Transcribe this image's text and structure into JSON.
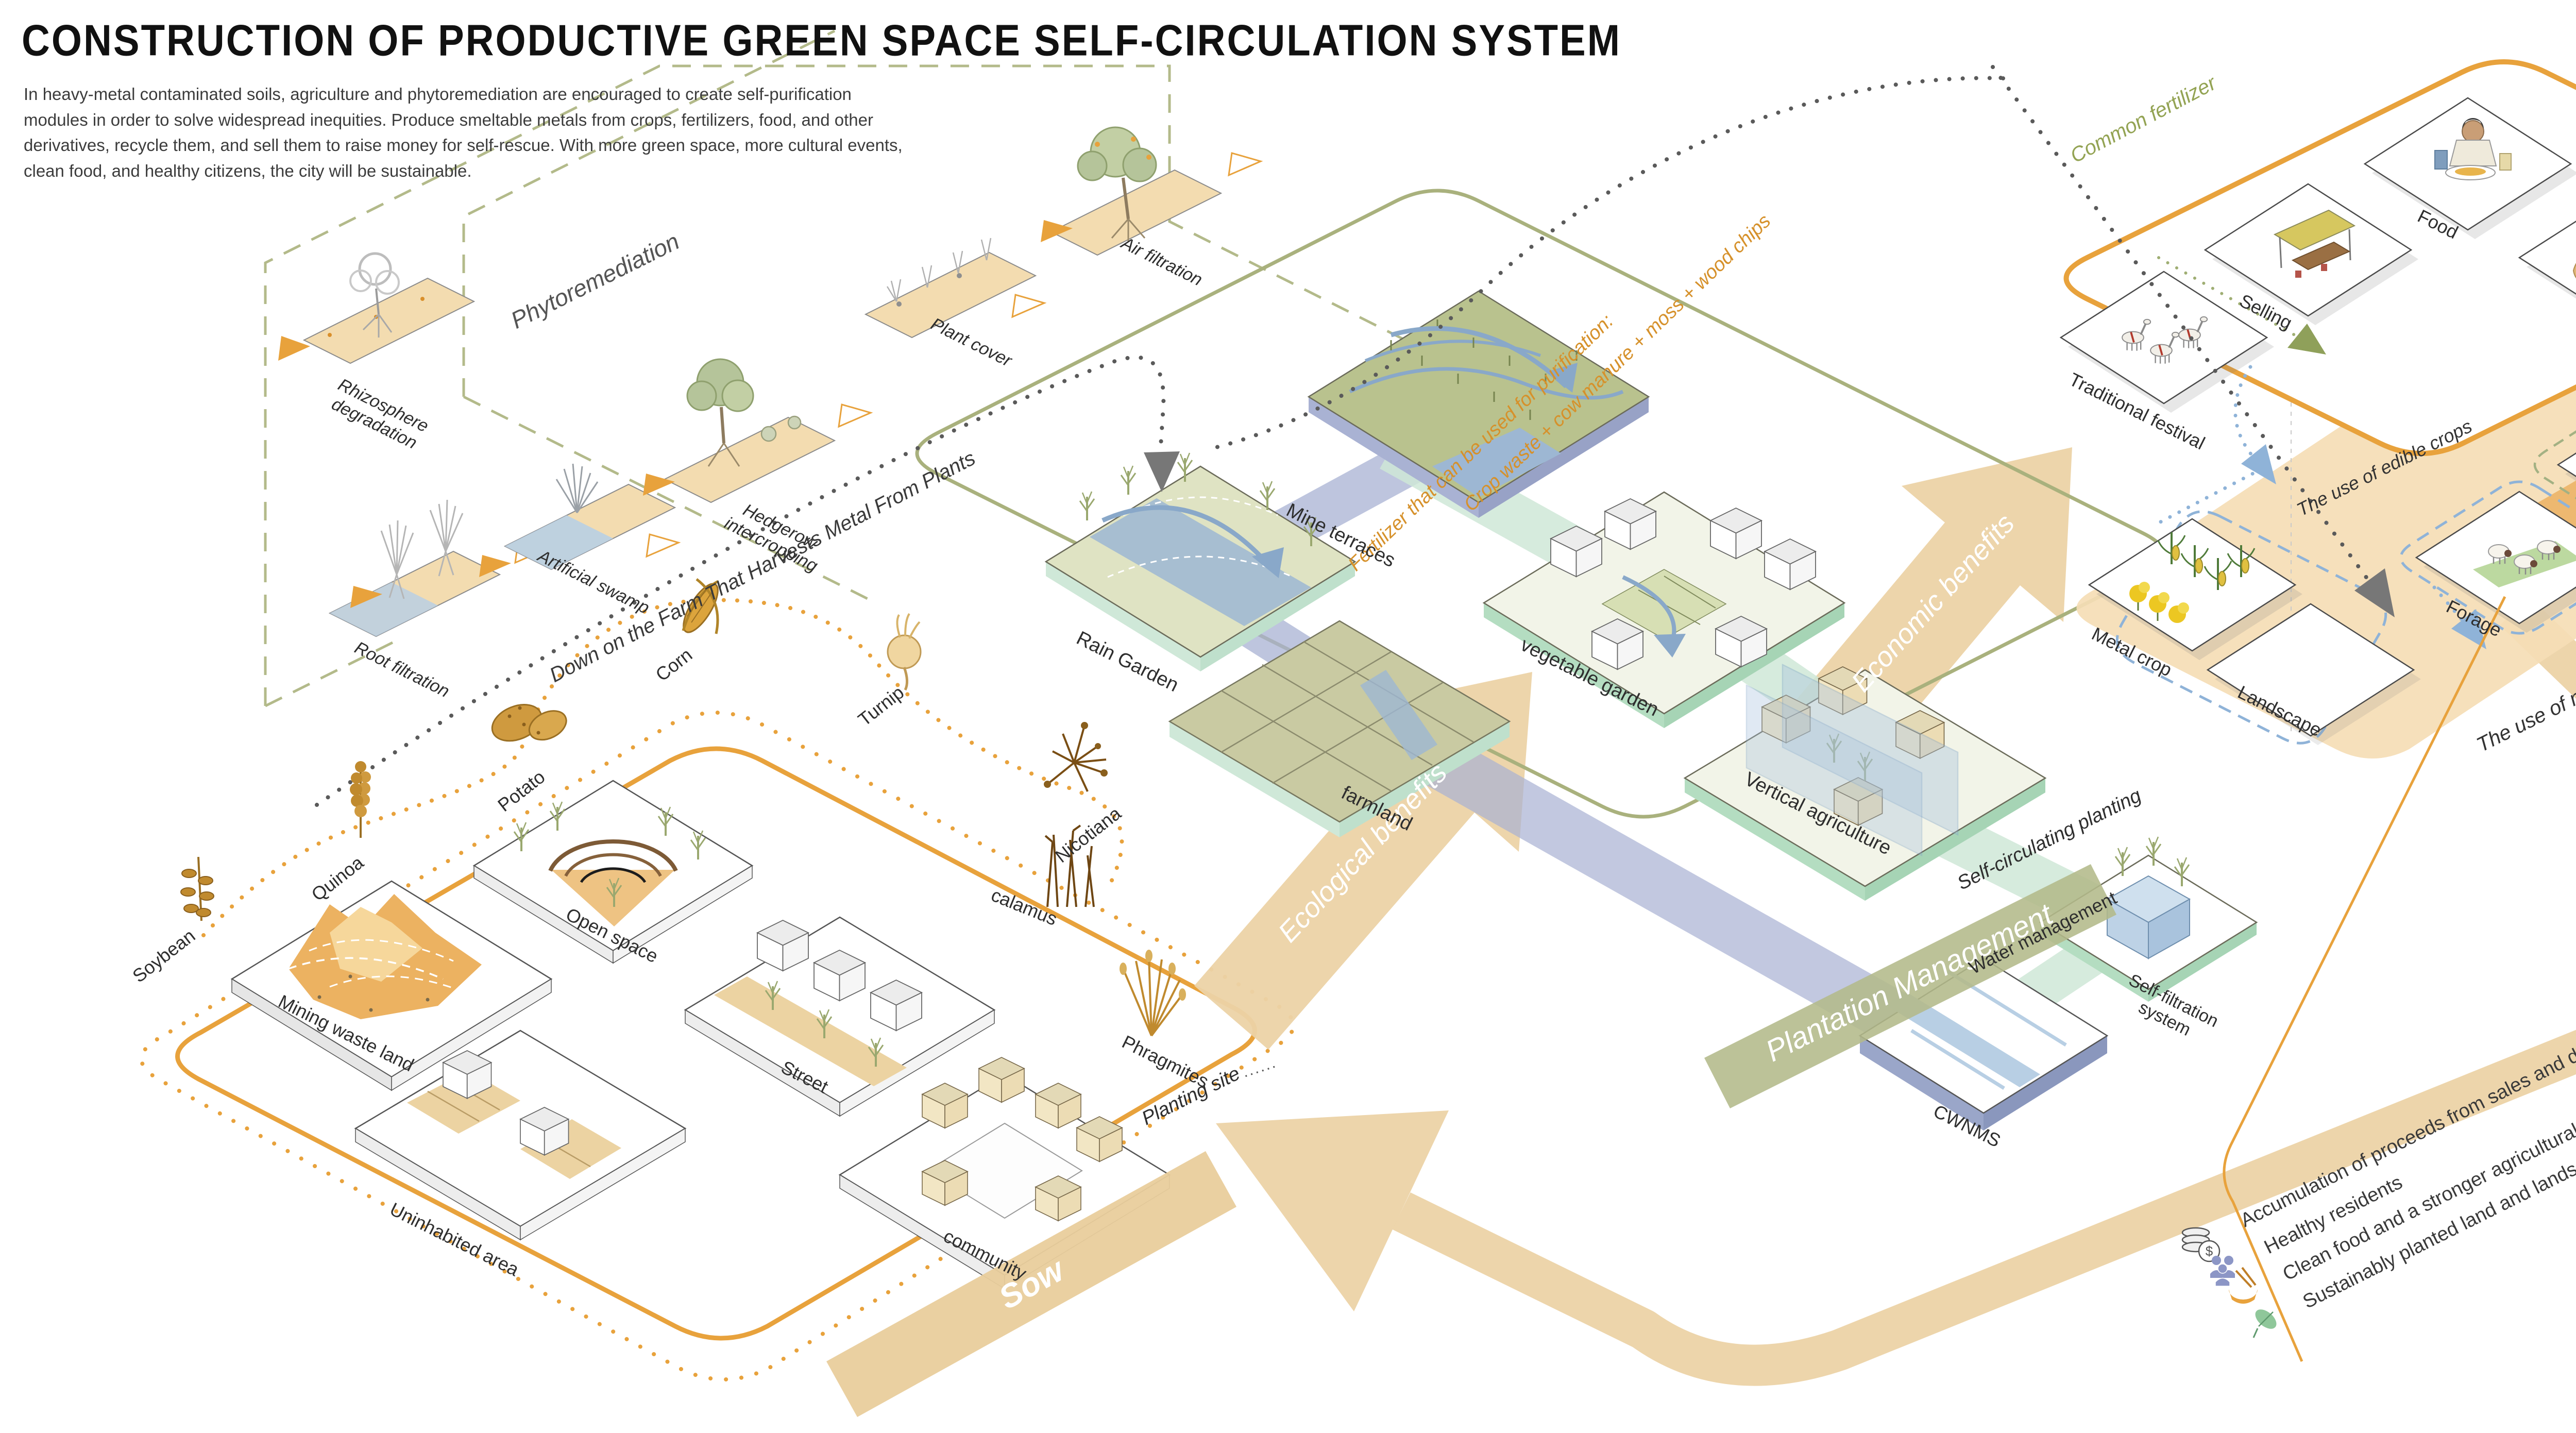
{
  "title": "CONSTRUCTION OF PRODUCTIVE GREEN SPACE SELF-CIRCULATION SYSTEM",
  "intro": "In heavy-metal contaminated soils, agriculture and phytoremediation are encouraged to create self-purification modules in order to solve widespread inequities. Produce smeltable metals from crops, fertilizers, food, and other derivatives, recycle them, and sell them to raise money for self-rescue. With more green space, more cultural events, clean food, and healthy citizens, the city will be sustainable.",
  "phyto": {
    "section_label": "Phytoremediation",
    "modules": [
      "Rhizosphere degradation",
      "Root filtration",
      "Artificial swamp",
      "Hedgerow intercropping",
      "Plant cover",
      "Air filtration"
    ]
  },
  "flows": {
    "farm_line": "Down on the Farm That Harvests Metal From Plants",
    "fertilizer_title": "Fertilizer that can be used for purification:",
    "fertilizer_recipe": "Crop waste + cow manure + moss + wood chips",
    "common_fertilizer": "Common fertilizer",
    "edible": "The use of edible crops",
    "non_edible": "The use of non-edible crops",
    "ellipsis": "......"
  },
  "arrows": {
    "ecological": "Ecological benefits",
    "economic": "Economic benefits"
  },
  "sow": {
    "stage": "Sow",
    "boundary": "Planting site",
    "sites": [
      "Mining waste land",
      "Open space",
      "Uninhabited area",
      "Street",
      "community"
    ],
    "crops": [
      "Soybean",
      "Quinoa",
      "Potato",
      "Corn",
      "Turnip",
      "Nicotiana",
      "calamus",
      "Phragmites"
    ]
  },
  "plantation": {
    "banner": "Plantation Management",
    "border_label": "Self-circulating planting",
    "modules": [
      "Rain Garden",
      "Mine terraces",
      "farmland",
      "vegetable garden",
      "Vertical agriculture"
    ],
    "water_label": "Water management",
    "filtration": "Self-filtration system",
    "cwnms": "CWNMS"
  },
  "harvest": {
    "banner": "Harvest & Application",
    "upper": [
      "Traditional festival",
      "Selling",
      "Food",
      "Stockpile"
    ],
    "lower": [
      "Metal crop",
      "Landscape",
      "Forage",
      "Compost"
    ]
  },
  "benefits": [
    {
      "icon": "coins-icon",
      "text": "Accumulation of proceeds from sales and derivative activities"
    },
    {
      "icon": "people-icon",
      "text": "Healthy residents"
    },
    {
      "icon": "bowl-icon",
      "text": "Clean food and a stronger agricultural culture"
    },
    {
      "icon": "leaf-icon",
      "text": "Sustainably planted land and landscape"
    }
  ],
  "colors": {
    "accent_orange": "#E8A23C",
    "olive": "#A9B17D",
    "mint": "#CFE8D8",
    "water_blue": "#9DB7D3",
    "band_tan": "#ECD3A6",
    "text_orange": "#D6912B",
    "text_green": "#93A353"
  }
}
